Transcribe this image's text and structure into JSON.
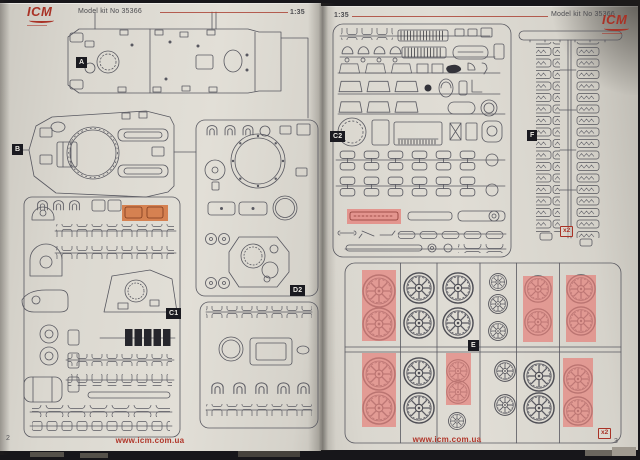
{
  "brand": "ICM",
  "kit_label": "Model kit No 35366",
  "scale_label": "1:35",
  "website": "www.icm.com.ua",
  "left_page": {
    "page_number": "2",
    "sprues": {
      "a": "A",
      "b": "B",
      "c1": "C1",
      "d2": "D2"
    }
  },
  "right_page": {
    "page_number": "3",
    "sprues": {
      "c2": "C2",
      "f": "F",
      "e": "E"
    },
    "f_quantity": "x2",
    "e_quantity": "x2"
  },
  "colors": {
    "accent_red": "#a93226",
    "part_highlight_red": "#e5837d",
    "part_highlight_orange": "#d4713a",
    "label_black": "#1a1a20",
    "page_paper": "#dcd8d0",
    "line_ink": "#585860"
  }
}
